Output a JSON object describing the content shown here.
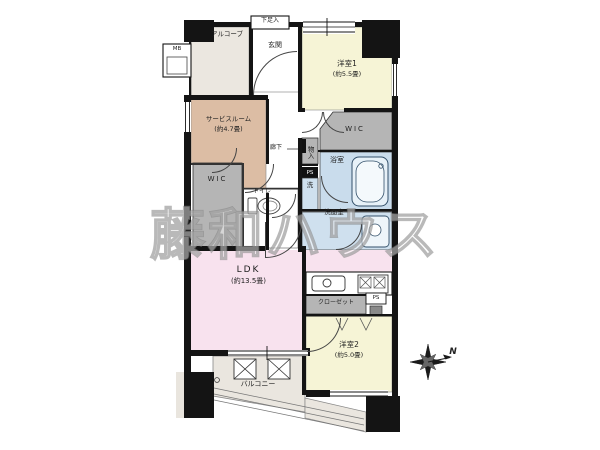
{
  "plan": {
    "watermark": "藤和ハウス",
    "compass_north": "N",
    "labels": {
      "shoe_cabinet": "下足入",
      "alcove": "アルコーブ",
      "meter_box": "MB",
      "entrance": "玄関",
      "bedroom1_name": "洋室1",
      "bedroom1_size": "(約5.5畳)",
      "wic_right": "WIC",
      "service_room_name": "サービスルーム",
      "service_room_size": "(約4.7畳)",
      "wic_left": "WIC",
      "toilet": "トイレ",
      "hallway": "廊下",
      "storage": "物入",
      "ps_upper": "PS",
      "laundry": "洗",
      "bathroom": "浴室",
      "washroom": "洗面室",
      "ldk_name": "LDK",
      "ldk_size": "(約13.5畳)",
      "closet": "クローゼット",
      "ps_lower": "PS",
      "bedroom2_name": "洋室2",
      "bedroom2_size": "(約5.0畳)",
      "balcony": "バルコニー"
    },
    "colors": {
      "wall": "#141414",
      "bedroom": "#f6f4d6",
      "service_room": "#dcbda4",
      "ldk": "#f8e2ee",
      "wet_area": "#cfe0ee",
      "bathroom": "#c9dcec",
      "closet_gray": "#b5b5b5",
      "alcove": "#ebe7e0",
      "balcony": "#eae6df",
      "white": "#ffffff",
      "tub": "#e7f1f8"
    }
  }
}
